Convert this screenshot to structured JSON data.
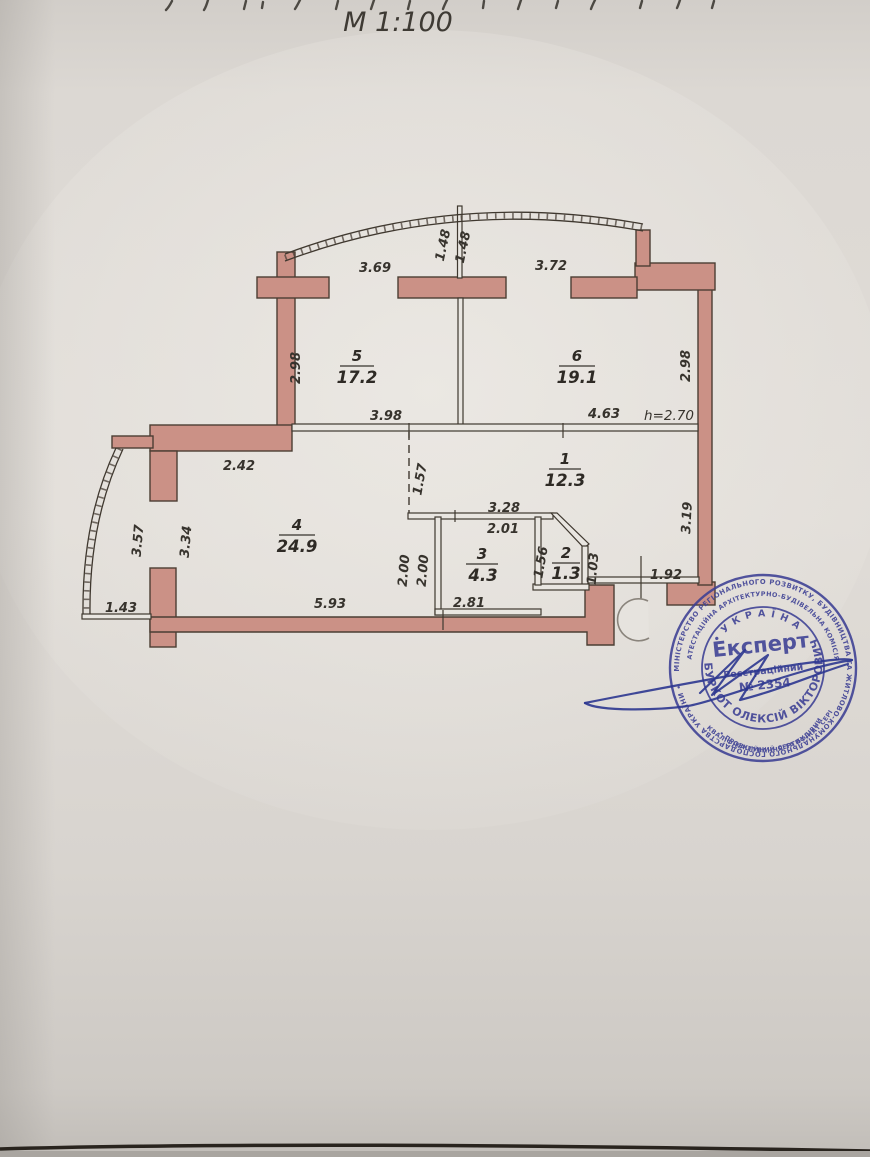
{
  "page": {
    "scale_label": "М 1:100"
  },
  "plan": {
    "height_note": "h=2.70",
    "rooms": {
      "r1": {
        "number": "1",
        "area": "12.3"
      },
      "r2": {
        "number": "2",
        "area": "1.3"
      },
      "r3": {
        "number": "3",
        "area": "4.3"
      },
      "r4": {
        "number": "4",
        "area": "24.9"
      },
      "r5": {
        "number": "5",
        "area": "17.2"
      },
      "r6": {
        "number": "6",
        "area": "19.1"
      }
    },
    "dims": {
      "top_balcony_left": "1.48",
      "top_balcony_right": "1.48",
      "room5_top": "3.69",
      "room6_top": "3.72",
      "room5_left": "2.98",
      "room6_right": "2.98",
      "room5_bottom": "3.98",
      "room6_bottom": "4.63",
      "room4_top": "2.42",
      "hall_left": "1.57",
      "hall_bottom": "3.28",
      "room3_top": "2.01",
      "balcony_left_outer": "3.57",
      "room4_left": "3.34",
      "room3_left_a": "2.00",
      "room3_left_b": "2.00",
      "room2_left": "1.56",
      "room2_right": "1.03",
      "hall_right": "3.19",
      "entrance_door": "1.92",
      "balcony_bottom_left": "1.43",
      "room4_bottom": "5.93",
      "room3_bottom": "2.81"
    }
  },
  "stamp": {
    "ring_outer": "МІНІСТЕРСТВО РЕГІОНАЛЬНОГО РОЗВИТКУ, БУДІВНИЦТВА ТА ЖИТЛОВО-КОМУНАЛЬНОГО ГОСПОДАРСТВА УКРАЇНИ •",
    "ring_inner": "АТЕСТАЦІЙНА АРХІТЕКТУРНО-БУДІВЕЛЬНА КОМІСІЯ",
    "ring_bottom_1": "КВАЛІФІКАЦІЙНИЙ СЕРТИФІКАТ СЕРІЯ АЕ",
    "ring_bottom_2": "• ПРОЕКТУВАННЯ ТА БУДІВНИЦТВО •",
    "country": "• У К Р А Ї Н А •",
    "title": "Експерт",
    "reg_label": "Реєстраційний",
    "reg_number": "№ 2354",
    "name": "БУРКОТ ОЛЕКСІЙ ВІКТОРОВИЧ",
    "ink_color": "#3c3f94"
  },
  "colors": {
    "wall_fill": "#cb9186",
    "outline": "#4b3e33",
    "paper": "#dcd8d3",
    "stamp_ink": "#3c3f94"
  }
}
